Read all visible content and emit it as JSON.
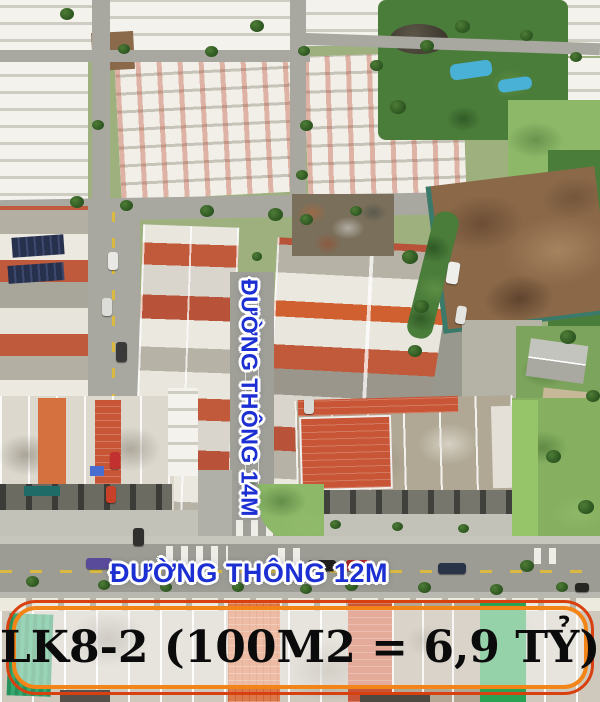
{
  "labels": {
    "vertical_road": "ĐƯỜNG THÔNG 14M",
    "horizontal_road": "ĐƯỜNG THÔNG 12M",
    "banner": "LK8-2 (100M2 = 6,9 TỶ)"
  },
  "colors": {
    "road_label_text": "#1c2fd2",
    "road_label_outline": "#ffffff",
    "banner_border_outer": "#d8400f",
    "banner_border_inner": "#f28418",
    "banner_background": "rgba(255,255,255,0.5)",
    "banner_text": "#0b0b0b",
    "red_roof": "#c05a3c",
    "dirt_lot": "#8a6848",
    "pool_blue": "#49b0d6"
  }
}
